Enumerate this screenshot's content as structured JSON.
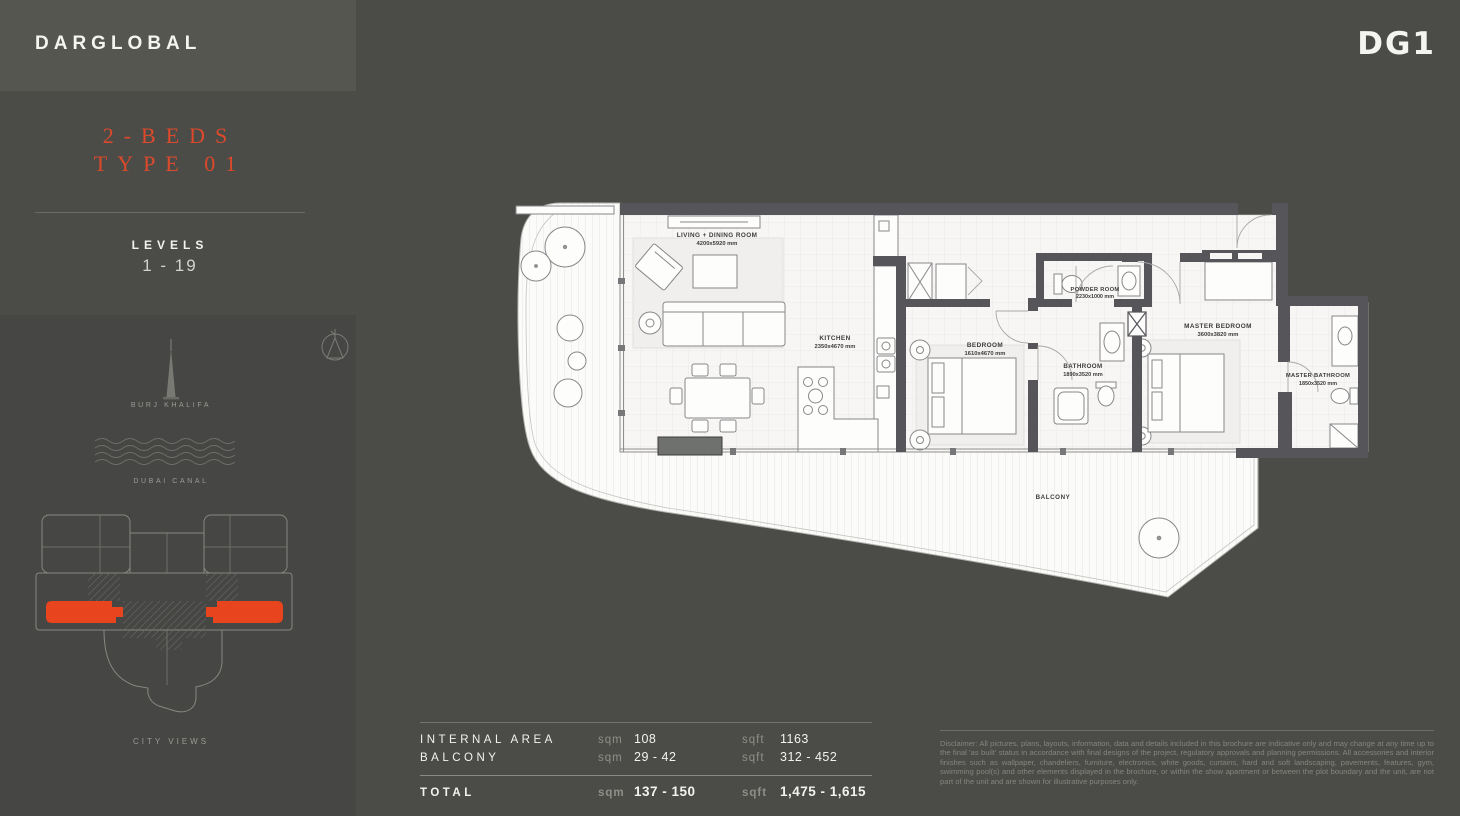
{
  "colors": {
    "accent": "#DC4A2B",
    "keyplan_orange": "#E8451F",
    "page_bg": "#4B4B48",
    "sidebar_panel_bg": "#464644",
    "header_bg": "#565651"
  },
  "brand": {
    "name": "DARGLOBAL",
    "unit_code": "DG1"
  },
  "sidebar": {
    "unit_type": "2-BEDS",
    "unit_variant": "TYPE 01",
    "levels_label": "LEVELS",
    "levels_value": "1 - 19",
    "landmark_burj": "BURJ KHALIFA",
    "landmark_canal": "DUBAI CANAL",
    "view_label": "CITY VIEWS"
  },
  "floor_plan": {
    "balcony_label": "BALCONY",
    "rooms": [
      {
        "name": "LIVING + DINING ROOM",
        "dims": "4200x5920 mm"
      },
      {
        "name": "KITCHEN",
        "dims": "2350x4670 mm"
      },
      {
        "name": "BEDROOM",
        "dims": "1610x4670 mm"
      },
      {
        "name": "POWDER ROOM",
        "dims": "2230x1000 mm"
      },
      {
        "name": "BATHROOM",
        "dims": "1890x3520 mm"
      },
      {
        "name": "MASTER BEDROOM",
        "dims": "3600x3820 mm"
      },
      {
        "name": "MASTER BATHROOM",
        "dims": "1850x3520 mm"
      }
    ]
  },
  "areas": {
    "unit_sqm": "sqm",
    "unit_sqft": "sqft",
    "rows": [
      {
        "label": "INTERNAL AREA",
        "sqm": "108",
        "sqft": "1163"
      },
      {
        "label": "BALCONY",
        "sqm": "29 - 42",
        "sqft": "312 - 452"
      }
    ],
    "total": {
      "label": "TOTAL",
      "sqm": "137 - 150",
      "sqft": "1,475 - 1,615"
    }
  },
  "disclaimer": "Disclaimer: All pictures, plans, layouts, information, data and details included in this brochure are indicative only and may change at any time up to the final 'as built' status in accordance with final designs of the project, regulatory approvals and planning permissions. All accessories and interior finishes such as wallpaper, chandeliers, furniture, electronics, white goods, curtains, hard and soft landscaping, pavements, features, gym, swimming pool(s) and other elements displayed in the brochure, or within the show apartment or between the plot boundary and the unit, are not part of the unit and are shown for illustrative purposes only."
}
